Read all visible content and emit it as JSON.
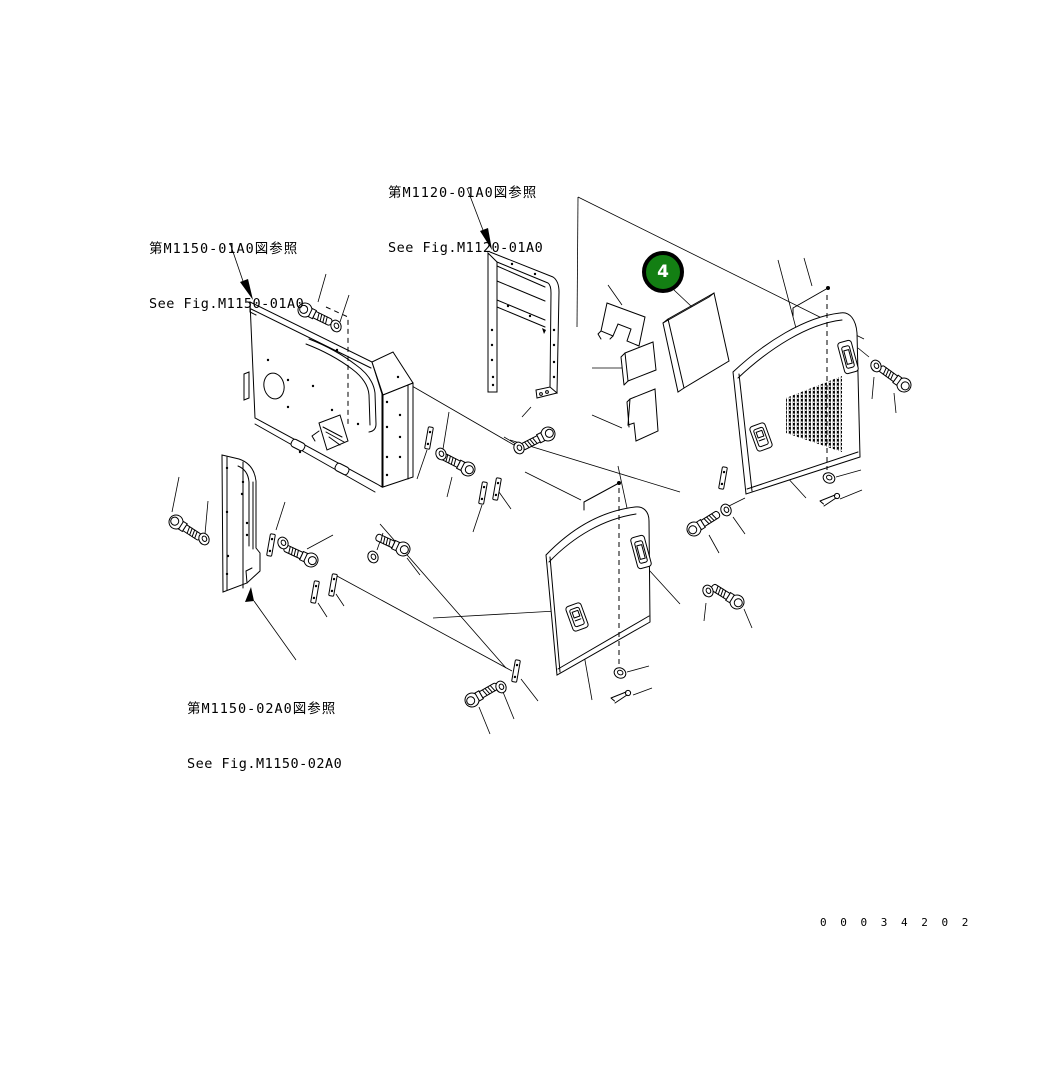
{
  "diagram": {
    "figure_references": [
      {
        "jp": "第M1120-01A0図参照",
        "en": "See Fig.M1120-01A0"
      },
      {
        "jp": "第M1150-01A0図参照",
        "en": "See Fig.M1150-01A0"
      },
      {
        "jp": "第M1150-02A0図参照",
        "en": "See Fig.M1150-02A0"
      }
    ],
    "callout": {
      "number": "4"
    },
    "drawing_number": "0 0 0 3 4 2 0 2",
    "colors": {
      "callout_fill": "#137f13",
      "callout_ring": "#000000",
      "callout_text": "#ffffff",
      "line": "#000000",
      "background": "#ffffff"
    }
  }
}
